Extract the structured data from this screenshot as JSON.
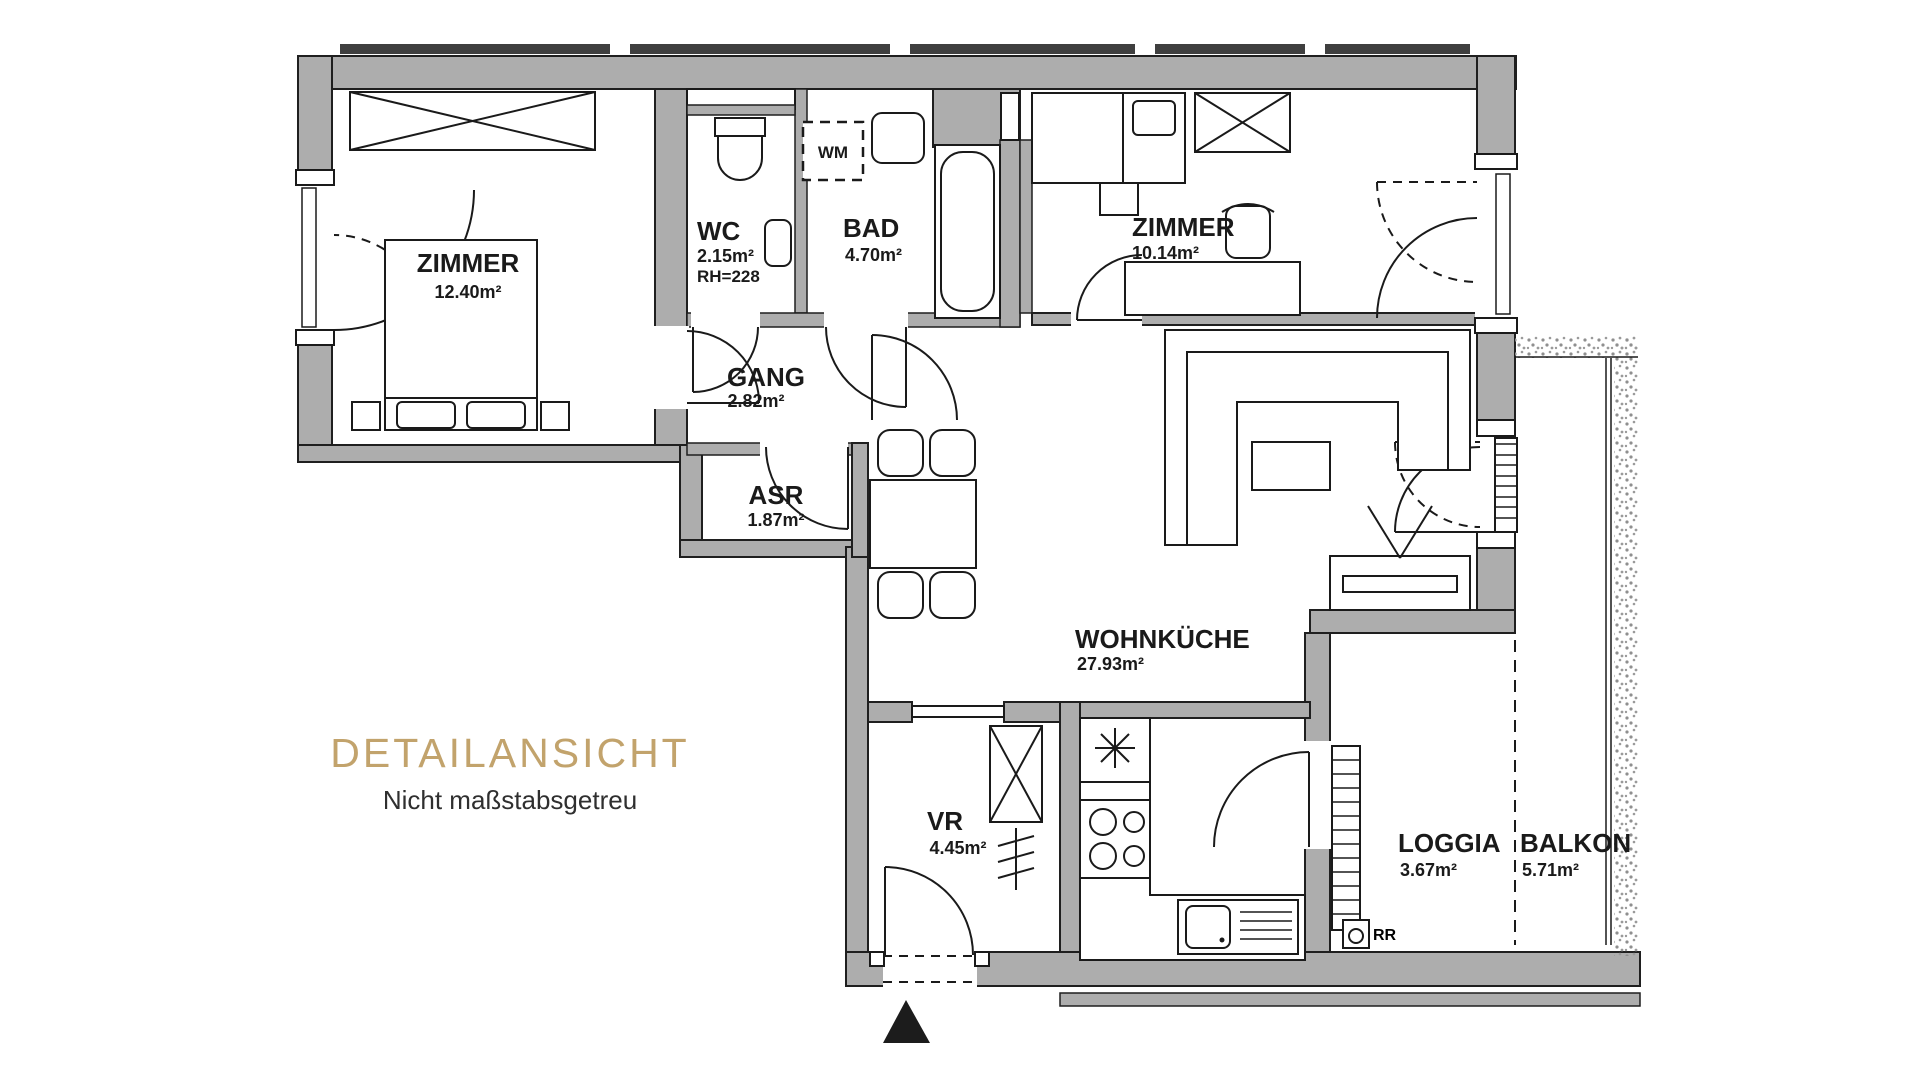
{
  "title": {
    "heading": "DETAILANSICHT",
    "subheading": "Nicht maßstabsgetreu"
  },
  "colors": {
    "accent_gold": "#c2a36c",
    "wall_gray": "#adadad",
    "line_black": "#1a1a1a"
  },
  "rooms": [
    {
      "id": "zimmer-main",
      "name": "ZIMMER",
      "area": "12.40m²"
    },
    {
      "id": "wc",
      "name": "WC",
      "area": "2.15m²",
      "note": "RH=228"
    },
    {
      "id": "bad",
      "name": "BAD",
      "area": "4.70m²"
    },
    {
      "id": "zimmer-2",
      "name": "ZIMMER",
      "area": "10.14m²"
    },
    {
      "id": "gang",
      "name": "GANG",
      "area": "2.82m²"
    },
    {
      "id": "asr",
      "name": "ASR",
      "area": "1.87m²"
    },
    {
      "id": "wohnkueche",
      "name": "WOHNKÜCHE",
      "area": "27.93m²"
    },
    {
      "id": "vr",
      "name": "VR",
      "area": "4.45m²"
    },
    {
      "id": "loggia",
      "name": "LOGGIA",
      "area": "3.67m²"
    },
    {
      "id": "balkon",
      "name": "BALKON",
      "area": "5.71m²"
    }
  ],
  "annotations": {
    "washing_machine": "WM",
    "rain_drain": "RR"
  }
}
